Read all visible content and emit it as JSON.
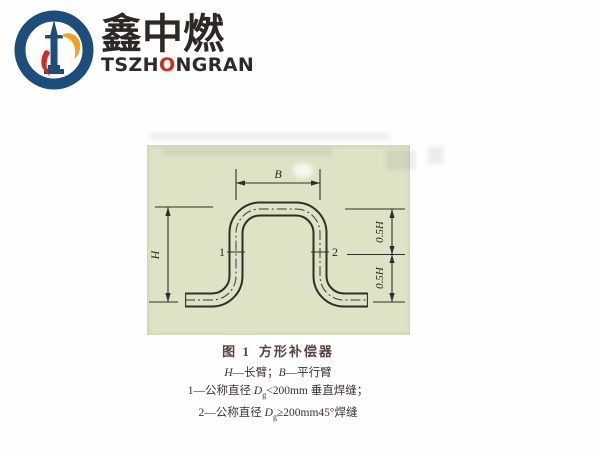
{
  "logo": {
    "company_cn": "鑫中燃",
    "en_pre": "TSZH",
    "en_o": "O",
    "en_post": "NGRAN",
    "colors": {
      "blue": "#1b4d7d",
      "red": "#d6291d",
      "orange": "#f5a01e"
    }
  },
  "diagram": {
    "background": "#dfe3c5",
    "labels": {
      "b": "B",
      "h": "H",
      "half_h_upper": "0.5H",
      "half_h_lower": "0.5H",
      "weld_1": "1",
      "weld_2": "2"
    }
  },
  "caption": {
    "figure_no": "图 1",
    "figure_title": "方形补偿器",
    "arms": {
      "h": "H",
      "h_desc": "—长臂；",
      "b": "B",
      "b_desc": "—平行臂"
    },
    "note1": {
      "num": "1—公称直径 ",
      "sym": "D",
      "sub": "g",
      "desc": "<200mm 垂直焊缝；"
    },
    "note2": {
      "num": "2—公称直径 ",
      "sym": "D",
      "sub": "g",
      "desc": "≥200mm45°焊缝"
    }
  }
}
